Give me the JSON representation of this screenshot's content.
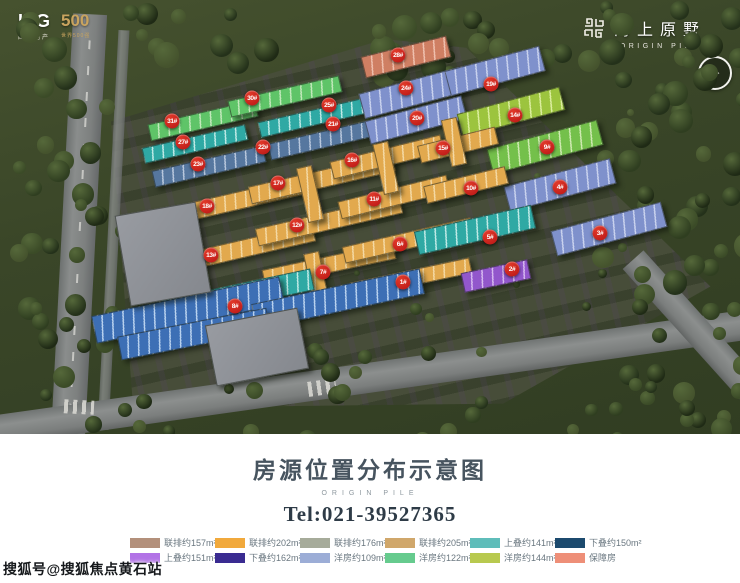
{
  "branding": {
    "itg": "ITG",
    "itg_sub": "国贸地产",
    "five_hundred": "500",
    "five_hundred_sub": "世界500强",
    "logo_cn": "海上原墅",
    "logo_en": "ORIGIN PILE"
  },
  "title_panel": {
    "title": "房源位置分布示意图",
    "subtitle": "ORIGIN PILE",
    "tel": "Tel:021-39527365"
  },
  "watermark": {
    "text": "搜狐号@搜狐焦点黄石站"
  },
  "legend": {
    "rows": [
      [
        {
          "label": "联排约157m²",
          "color": "#b3907b"
        },
        {
          "label": "联排约202m²",
          "color": "#f1a93c"
        },
        {
          "label": "联排约176m²",
          "color": "#a6ab9a"
        },
        {
          "label": "联排约205m²",
          "color": "#d0a76b"
        },
        {
          "label": "上叠约141m²",
          "color": "#5fbdba"
        },
        {
          "label": "下叠约150m²",
          "color": "#1c4a6e"
        }
      ],
      [
        {
          "label": "上叠约151m²",
          "color": "#b273e6"
        },
        {
          "label": "下叠约162m²",
          "color": "#3a2b91"
        },
        {
          "label": "洋房约109m²",
          "color": "#9cadd6"
        },
        {
          "label": "洋房约122m²",
          "color": "#66cb8e"
        },
        {
          "label": "洋房约144m²",
          "color": "#b8c94f"
        },
        {
          "label": "保障房",
          "color": "#ee8f78"
        }
      ]
    ]
  },
  "map": {
    "marker_color": "#b71414",
    "palette": {
      "green": [
        "#5fc468",
        "#c2e9bb"
      ],
      "teal": [
        "#2fa9a4",
        "#bfeae6"
      ],
      "blue": [
        "#7f91cc",
        "#c9d2ee"
      ],
      "steel": [
        "#56779f",
        "#b9c8dd"
      ],
      "bblue": [
        "#3d6fb5",
        "#b9d2ef"
      ],
      "yellow": [
        "#e2a94e",
        "#f4d9a4"
      ],
      "lime": [
        "#9cc43e",
        "#dcee9f"
      ],
      "lime2": [
        "#74c04b",
        "#cfeab2"
      ],
      "salmon": [
        "#cf7f63",
        "#efc0ae"
      ],
      "purple": [
        "#9257cc",
        "#d6b9f0"
      ],
      "gray": [
        "#989ba1",
        "#85888e"
      ]
    },
    "buildings": [
      {
        "x": 148,
        "y": 112,
        "w": 108,
        "h": 15,
        "rot": -13,
        "c": "green"
      },
      {
        "x": 228,
        "y": 88,
        "w": 112,
        "h": 15,
        "rot": -13,
        "c": "green"
      },
      {
        "x": 142,
        "y": 136,
        "w": 104,
        "h": 14,
        "rot": -13,
        "c": "teal"
      },
      {
        "x": 258,
        "y": 110,
        "w": 106,
        "h": 14,
        "rot": -13,
        "c": "teal"
      },
      {
        "x": 152,
        "y": 158,
        "w": 112,
        "h": 15,
        "rot": -13,
        "c": "steel"
      },
      {
        "x": 268,
        "y": 131,
        "w": 110,
        "h": 15,
        "rot": -13,
        "c": "steel"
      },
      {
        "x": 362,
        "y": 46,
        "w": 86,
        "h": 20,
        "rot": -14,
        "c": "salmon"
      },
      {
        "x": 360,
        "y": 80,
        "w": 102,
        "h": 24,
        "rot": -15,
        "c": "blue"
      },
      {
        "x": 446,
        "y": 58,
        "w": 96,
        "h": 24,
        "rot": -15,
        "c": "blue"
      },
      {
        "x": 366,
        "y": 108,
        "w": 98,
        "h": 22,
        "rot": -15,
        "c": "blue"
      },
      {
        "x": 505,
        "y": 172,
        "w": 108,
        "h": 24,
        "rot": -15,
        "c": "blue"
      },
      {
        "x": 552,
        "y": 216,
        "w": 112,
        "h": 24,
        "rot": -15,
        "c": "blue"
      },
      {
        "x": 458,
        "y": 100,
        "w": 104,
        "h": 22,
        "rot": -15,
        "c": "lime"
      },
      {
        "x": 488,
        "y": 134,
        "w": 112,
        "h": 24,
        "rot": -15,
        "c": "lime2"
      },
      {
        "x": 162,
        "y": 192,
        "w": 148,
        "h": 16,
        "rot": -13,
        "c": "yellow"
      },
      {
        "x": 248,
        "y": 170,
        "w": 146,
        "h": 16,
        "rot": -13,
        "c": "yellow"
      },
      {
        "x": 330,
        "y": 148,
        "w": 112,
        "h": 16,
        "rot": -14,
        "c": "yellow"
      },
      {
        "x": 418,
        "y": 136,
        "w": 78,
        "h": 16,
        "rot": -14,
        "c": "yellow"
      },
      {
        "x": 168,
        "y": 240,
        "w": 146,
        "h": 16,
        "rot": -13,
        "c": "yellow"
      },
      {
        "x": 255,
        "y": 212,
        "w": 146,
        "h": 16,
        "rot": -13,
        "c": "yellow"
      },
      {
        "x": 338,
        "y": 188,
        "w": 110,
        "h": 16,
        "rot": -14,
        "c": "yellow"
      },
      {
        "x": 424,
        "y": 176,
        "w": 82,
        "h": 16,
        "rot": -14,
        "c": "yellow"
      },
      {
        "x": 262,
        "y": 256,
        "w": 132,
        "h": 15,
        "rot": -12,
        "c": "yellow"
      },
      {
        "x": 342,
        "y": 232,
        "w": 130,
        "h": 15,
        "rot": -13,
        "c": "yellow"
      },
      {
        "x": 350,
        "y": 270,
        "w": 120,
        "h": 14,
        "rot": -12,
        "c": "yellow"
      },
      {
        "x": 302,
        "y": 166,
        "w": 14,
        "h": 54,
        "rot": -13,
        "c": "yellow"
      },
      {
        "x": 378,
        "y": 142,
        "w": 14,
        "h": 50,
        "rot": -13,
        "c": "yellow"
      },
      {
        "x": 446,
        "y": 118,
        "w": 14,
        "h": 46,
        "rot": -13,
        "c": "yellow"
      },
      {
        "x": 308,
        "y": 252,
        "w": 14,
        "h": 46,
        "rot": -12,
        "c": "yellow"
      },
      {
        "x": 415,
        "y": 218,
        "w": 118,
        "h": 22,
        "rot": -13,
        "c": "teal"
      },
      {
        "x": 162,
        "y": 284,
        "w": 150,
        "h": 20,
        "rot": -12,
        "c": "teal"
      },
      {
        "x": 92,
        "y": 296,
        "w": 190,
        "h": 26,
        "rot": -12,
        "c": "bblue"
      },
      {
        "x": 252,
        "y": 286,
        "w": 170,
        "h": 24,
        "rot": -12,
        "c": "bblue"
      },
      {
        "x": 118,
        "y": 322,
        "w": 150,
        "h": 22,
        "rot": -11,
        "c": "bblue"
      },
      {
        "x": 462,
        "y": 266,
        "w": 66,
        "h": 18,
        "rot": -12,
        "c": "purple"
      },
      {
        "x": 122,
        "y": 208,
        "w": 80,
        "h": 90,
        "rot": -10,
        "c": "gray"
      },
      {
        "x": 210,
        "y": 316,
        "w": 92,
        "h": 60,
        "rot": -11,
        "c": "gray"
      }
    ],
    "markers": [
      {
        "label": "31#",
        "x": 172,
        "y": 121
      },
      {
        "label": "30#",
        "x": 252,
        "y": 98
      },
      {
        "label": "28#",
        "x": 398,
        "y": 55
      },
      {
        "label": "27#",
        "x": 183,
        "y": 142
      },
      {
        "label": "25#",
        "x": 329,
        "y": 105
      },
      {
        "label": "24#",
        "x": 406,
        "y": 88
      },
      {
        "label": "23#",
        "x": 198,
        "y": 164
      },
      {
        "label": "22#",
        "x": 263,
        "y": 147
      },
      {
        "label": "21#",
        "x": 333,
        "y": 124
      },
      {
        "label": "20#",
        "x": 417,
        "y": 118
      },
      {
        "label": "19#",
        "x": 491,
        "y": 84
      },
      {
        "label": "18#",
        "x": 207,
        "y": 206
      },
      {
        "label": "17#",
        "x": 278,
        "y": 183
      },
      {
        "label": "16#",
        "x": 352,
        "y": 160
      },
      {
        "label": "15#",
        "x": 443,
        "y": 148
      },
      {
        "label": "14#",
        "x": 515,
        "y": 115
      },
      {
        "label": "13#",
        "x": 211,
        "y": 255
      },
      {
        "label": "12#",
        "x": 297,
        "y": 225
      },
      {
        "label": "11#",
        "x": 374,
        "y": 199
      },
      {
        "label": "10#",
        "x": 471,
        "y": 188
      },
      {
        "label": "9#",
        "x": 547,
        "y": 147
      },
      {
        "label": "8#",
        "x": 235,
        "y": 306
      },
      {
        "label": "7#",
        "x": 323,
        "y": 272
      },
      {
        "label": "6#",
        "x": 400,
        "y": 244
      },
      {
        "label": "5#",
        "x": 490,
        "y": 237
      },
      {
        "label": "4#",
        "x": 560,
        "y": 187
      },
      {
        "label": "3#",
        "x": 600,
        "y": 233
      },
      {
        "label": "2#",
        "x": 512,
        "y": 269
      },
      {
        "label": "1#",
        "x": 403,
        "y": 282
      }
    ]
  }
}
